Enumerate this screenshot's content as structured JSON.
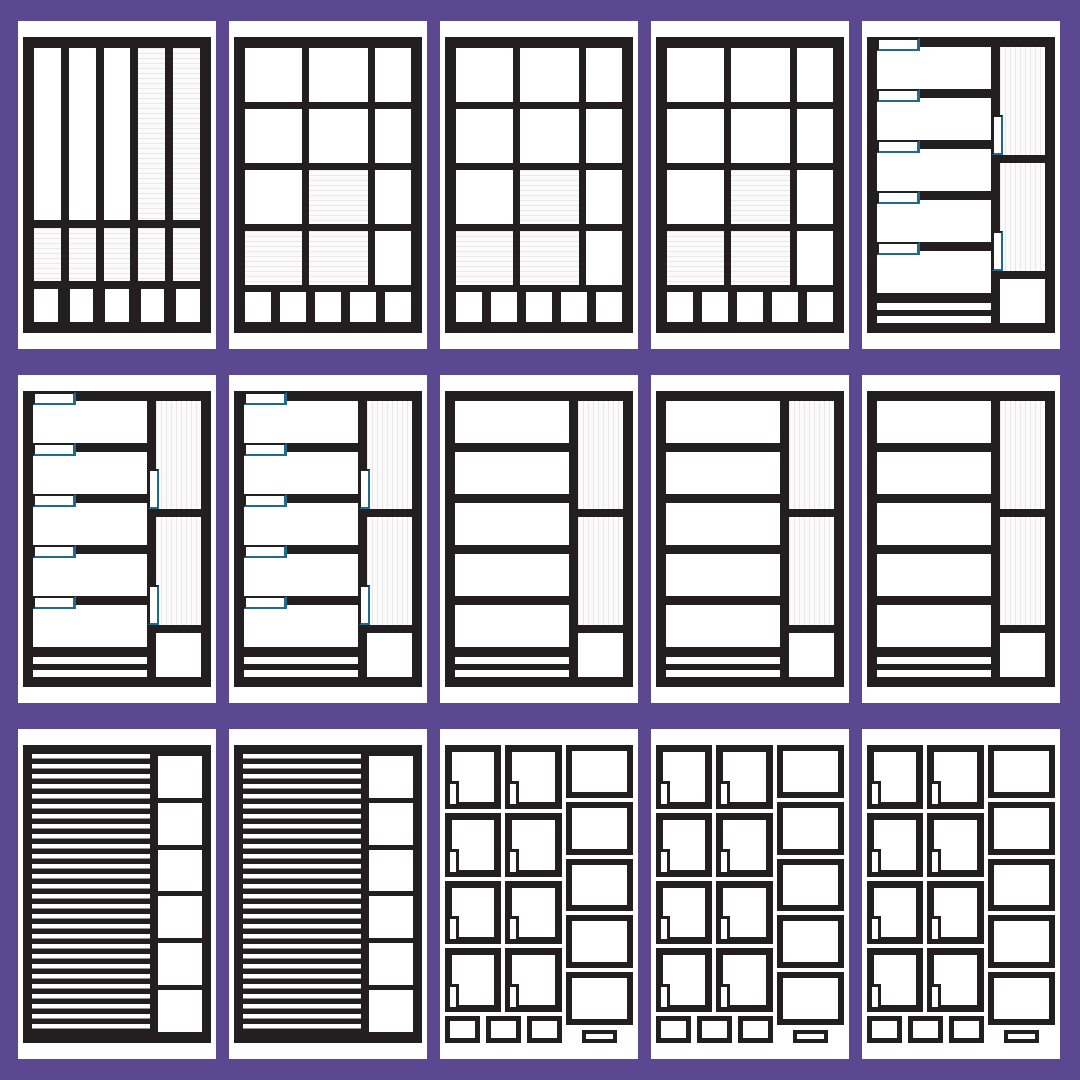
{
  "poster": {
    "kind": "planner-template-sheet",
    "grid": {
      "rows": 3,
      "cols": 5
    },
    "colors": {
      "background": "#5b4890",
      "card": "#ffffff",
      "ink": "#231f20",
      "accent_teal": "#1e6b8c",
      "ruled_line": "#e9e7e7"
    }
  },
  "layout": [
    [
      "columns",
      "grid",
      "grid",
      "grid",
      "tabbed_rows"
    ],
    [
      "tabbed_rows",
      "tabbed_rows",
      "plain_rows",
      "plain_rows",
      "plain_rows"
    ],
    [
      "striped_notes",
      "striped_notes",
      "photo_grid",
      "photo_grid",
      "photo_grid"
    ]
  ],
  "templates": {
    "columns": {
      "top_columns": 5,
      "ruled_top_columns": [
        3,
        4
      ],
      "mid_cells": 5,
      "mid_cells_ruled": true,
      "bottom_boxes": 5
    },
    "grid": {
      "cols": 3,
      "rows": 4,
      "col_ratios": [
        60,
        63,
        38
      ],
      "ruled_cells": [
        [
          2,
          1
        ],
        [
          3,
          0
        ],
        [
          3,
          1
        ]
      ],
      "bottom_boxes": 5
    },
    "tabbed_rows": {
      "rows": 5,
      "row_tabs": true,
      "bottom_bars": 2,
      "side_panels": 2,
      "side_panel_stripes": "vertical",
      "side_panel_tabs": true,
      "corner_box": true
    },
    "plain_rows": {
      "rows": 5,
      "row_tabs": false,
      "bottom_bars": 2,
      "side_panels": 2,
      "side_panel_stripes": "vertical",
      "side_panel_tabs": false,
      "corner_box": true
    },
    "striped_notes": {
      "stripe_area": "left",
      "side_boxes": 6
    },
    "photo_grid": {
      "left_cols": 2,
      "left_rows": 4,
      "corner_tab": "bottom-left",
      "side_boxes": 5,
      "footer_boxes": 3,
      "side_label_bar": true
    }
  }
}
